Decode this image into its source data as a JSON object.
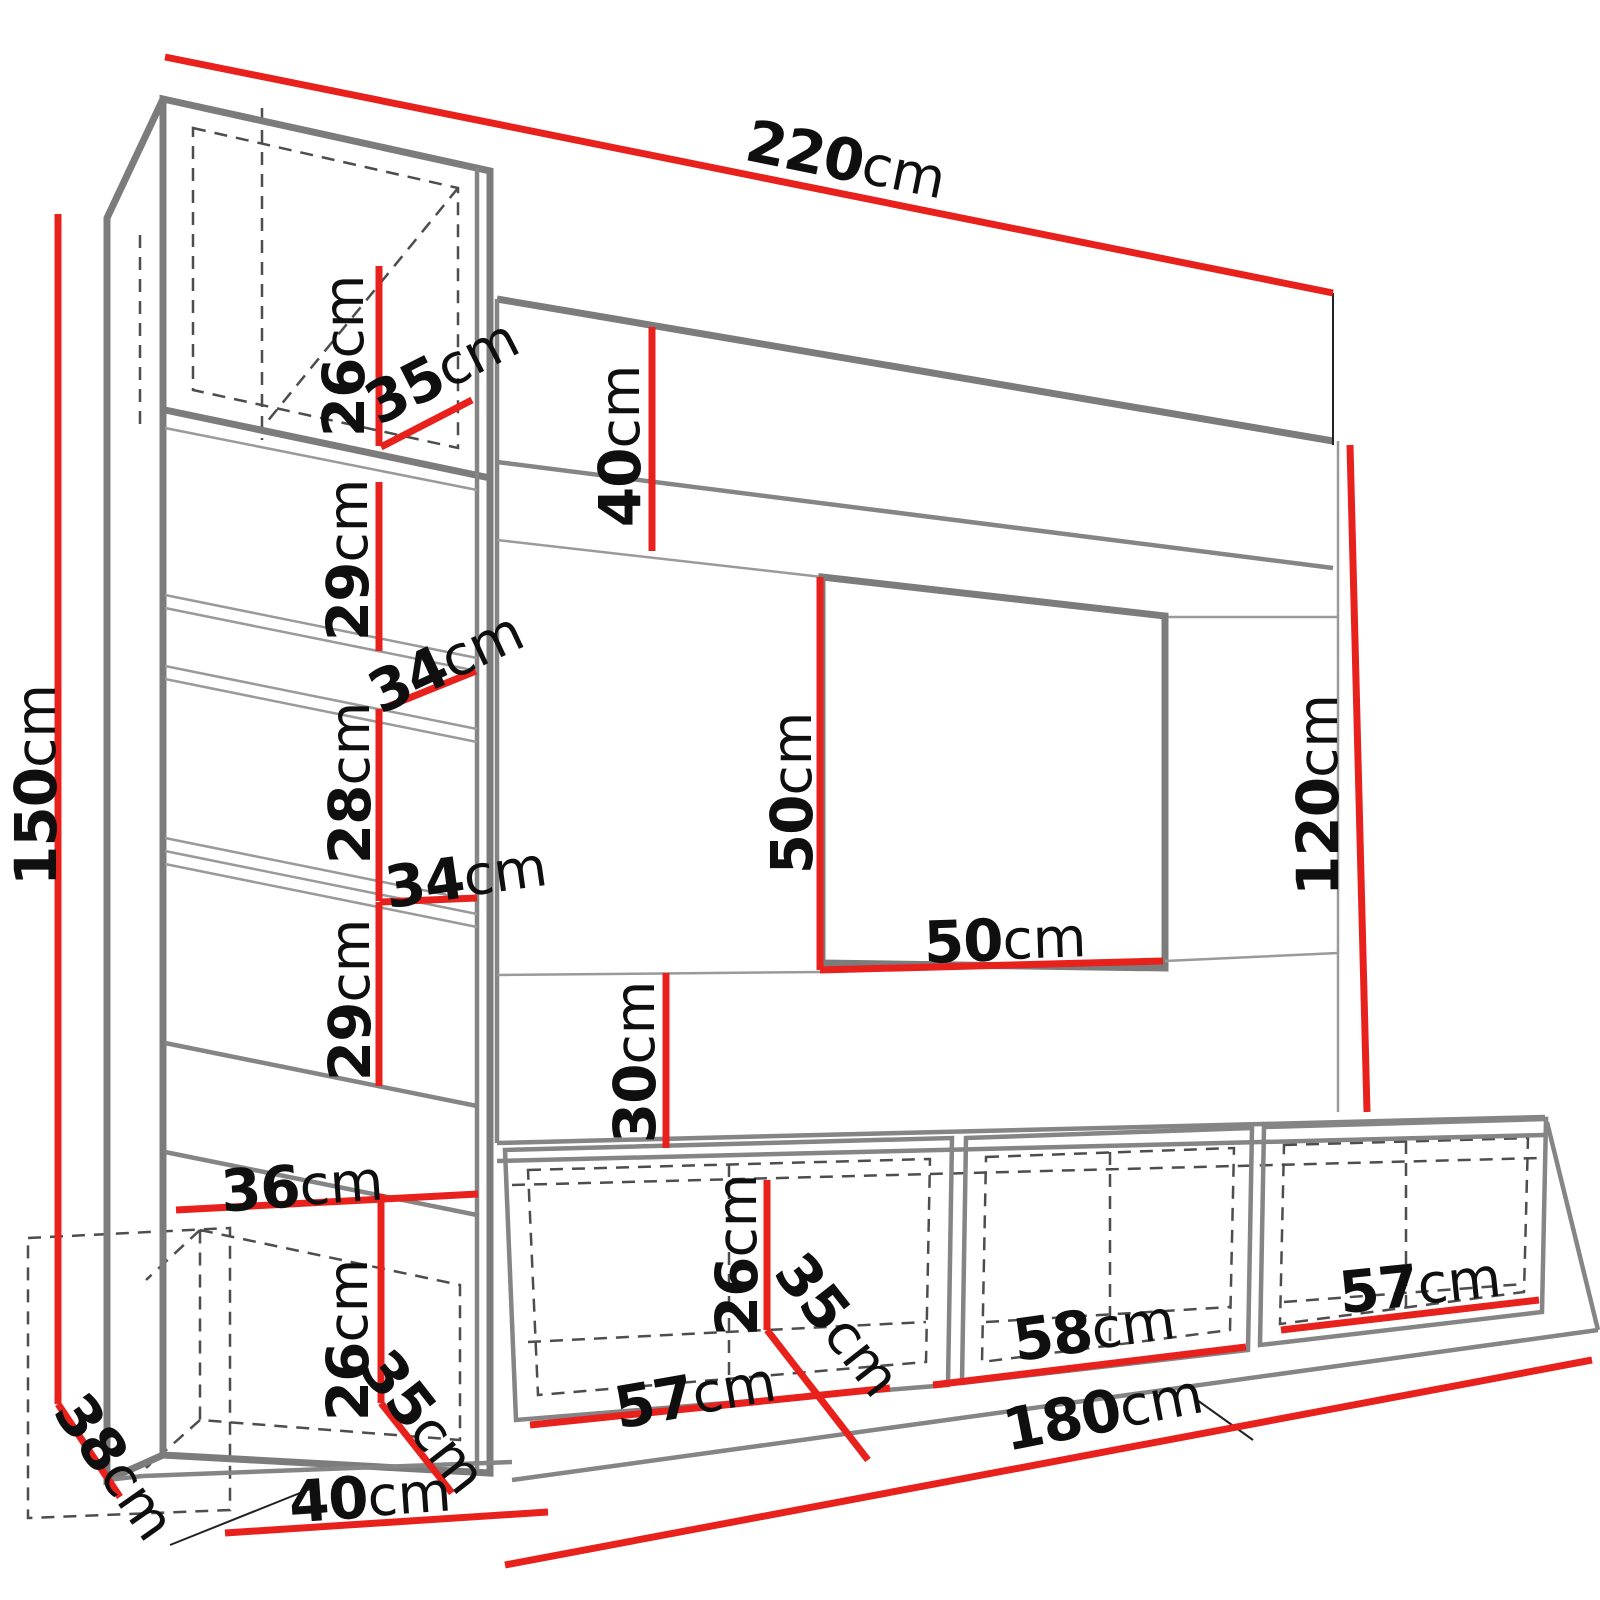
{
  "diagram": {
    "type": "furniture-dimension-drawing",
    "subject": "wall-unit entertainment center wireframe with measurements",
    "unit": "cm",
    "colors": {
      "dimension_line": "#e8211d",
      "outline": "#7c7c7c",
      "hidden_edge": "#4d4d4d",
      "label_text": "#0f0f0f",
      "background": "#ffffff"
    },
    "labels": [
      {
        "id": "total-width",
        "value": "220",
        "unit": "cm"
      },
      {
        "id": "total-height",
        "value": "150",
        "unit": "cm"
      },
      {
        "id": "top-cabinet-height",
        "value": "26",
        "unit": "cm"
      },
      {
        "id": "top-cabinet-depth",
        "value": "35",
        "unit": "cm"
      },
      {
        "id": "header-panel-height",
        "value": "40",
        "unit": "cm"
      },
      {
        "id": "shelf-opening-1-height",
        "value": "29",
        "unit": "cm"
      },
      {
        "id": "shelf-gap-1-width",
        "value": "34",
        "unit": "cm"
      },
      {
        "id": "shelf-opening-2-height",
        "value": "28",
        "unit": "cm"
      },
      {
        "id": "shelf-gap-2-width",
        "value": "34",
        "unit": "cm"
      },
      {
        "id": "shelf-opening-3-height",
        "value": "29",
        "unit": "cm"
      },
      {
        "id": "lower-shelf-width",
        "value": "36",
        "unit": "cm"
      },
      {
        "id": "left-base-cabinet-height",
        "value": "26",
        "unit": "cm"
      },
      {
        "id": "left-base-cabinet-depth",
        "value": "35",
        "unit": "cm"
      },
      {
        "id": "unit-depth",
        "value": "38",
        "unit": "cm"
      },
      {
        "id": "left-column-width",
        "value": "40",
        "unit": "cm"
      },
      {
        "id": "tv-recess-height",
        "value": "50",
        "unit": "cm"
      },
      {
        "id": "tv-recess-width",
        "value": "50",
        "unit": "cm"
      },
      {
        "id": "below-recess-height",
        "value": "30",
        "unit": "cm"
      },
      {
        "id": "right-panel-height",
        "value": "120",
        "unit": "cm"
      },
      {
        "id": "media-cabinet-height",
        "value": "26",
        "unit": "cm"
      },
      {
        "id": "media-cabinet-depth",
        "value": "35",
        "unit": "cm"
      },
      {
        "id": "media-cabinet-1-width",
        "value": "57",
        "unit": "cm"
      },
      {
        "id": "media-cabinet-2-width",
        "value": "58",
        "unit": "cm"
      },
      {
        "id": "media-cabinet-3-width",
        "value": "57",
        "unit": "cm"
      },
      {
        "id": "media-row-width",
        "value": "180",
        "unit": "cm"
      }
    ]
  }
}
